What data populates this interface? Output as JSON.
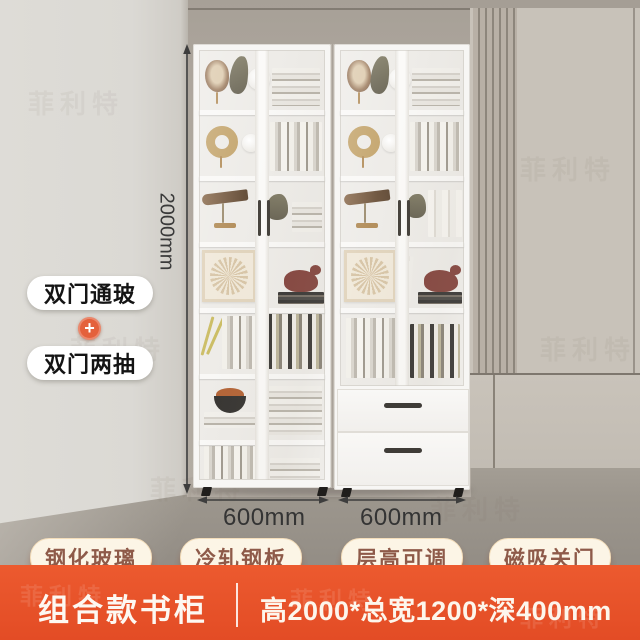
{
  "brand": {
    "watermark": "菲利特"
  },
  "overlay_labels": {
    "config_top": "双门通玻",
    "config_plus": "+",
    "config_bottom": "双门两抽"
  },
  "dimensions": {
    "height_label": "2000mm",
    "width_left_label": "600mm",
    "width_right_label": "600mm"
  },
  "feature_tags": [
    {
      "label": "钢化玻璃"
    },
    {
      "label": "冷轧钢板"
    },
    {
      "label": "层高可调"
    },
    {
      "label": "磁吸关门"
    }
  ],
  "footer": {
    "product_title": "组合款书柜",
    "spec_text": "高2000*总宽1200*深400mm"
  },
  "colors": {
    "accent_orange": "#E6502A",
    "tag_background": "#FCF5E6",
    "tag_text": "#8E5A49",
    "wall_left": "#DCDAD5",
    "wall_right": "#C8C2B9",
    "floor": "#9C968D",
    "cabinet_white": "#F7F6F4"
  }
}
